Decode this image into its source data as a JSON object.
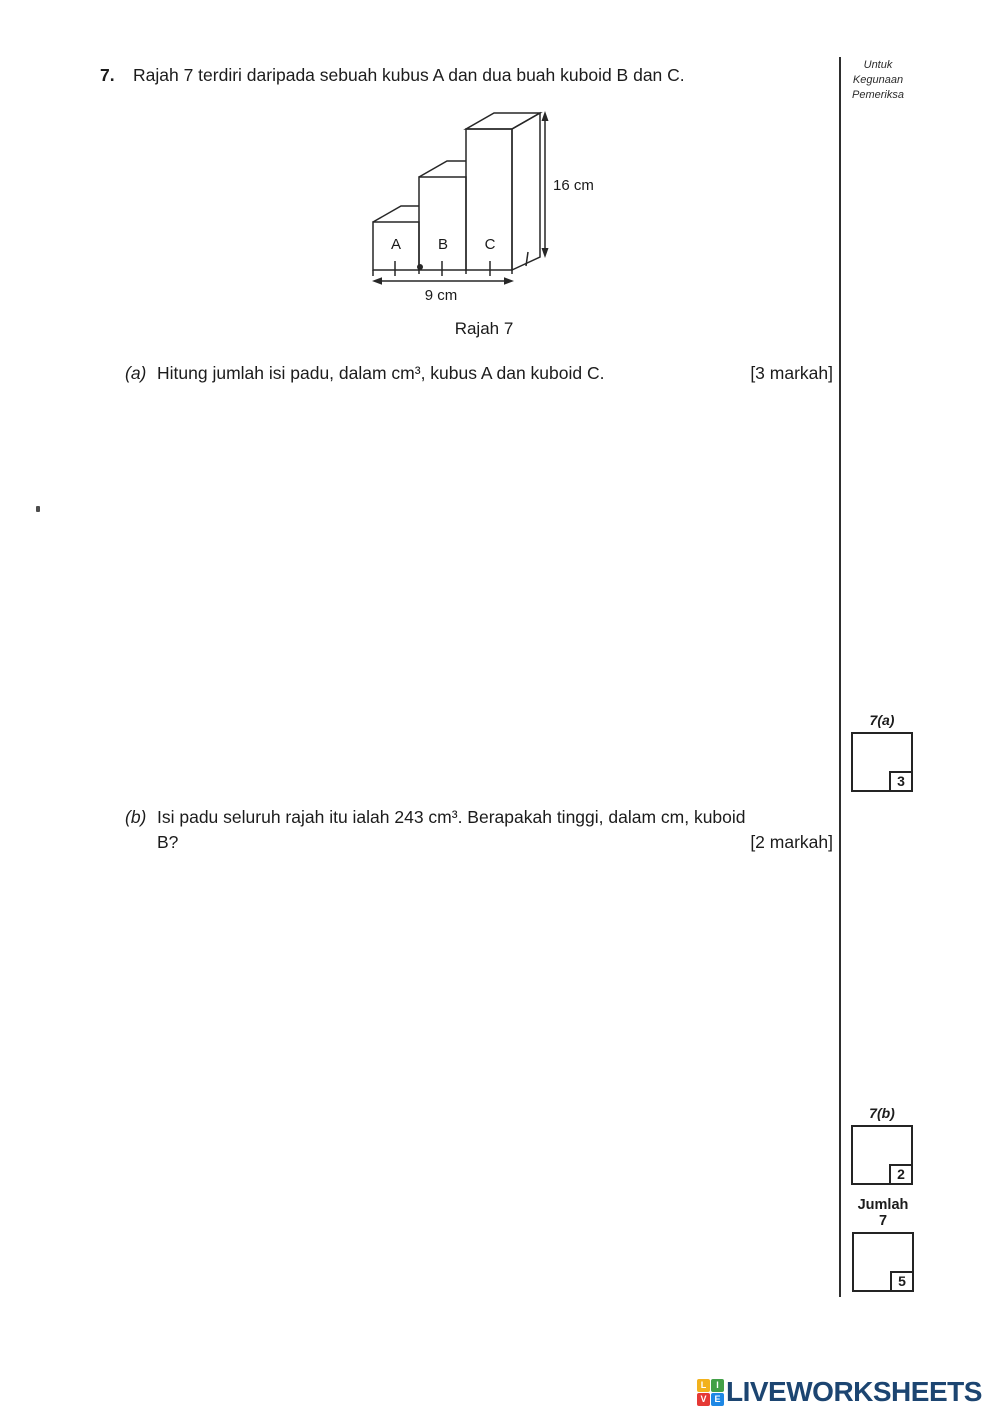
{
  "question": {
    "number": "7.",
    "text": "Rajah 7 terdiri daripada sebuah kubus A dan dua buah kuboid B dan C.",
    "parts": [
      {
        "letter": "(a)",
        "text": "Hitung jumlah isi padu, dalam cm³, kubus A dan kuboid C.",
        "marks": "[3 markah]"
      },
      {
        "letter": "(b)",
        "text_line1": "Isi padu seluruh rajah itu ialah 243 cm³. Berapakah tinggi, dalam cm, kuboid",
        "text_line2": "B?",
        "marks": "[2 markah]"
      }
    ]
  },
  "diagram": {
    "labels": {
      "a": "A",
      "b": "B",
      "c": "C"
    },
    "height_label": "16 cm",
    "base_label": "9 cm",
    "caption": "Rajah 7"
  },
  "examiner": {
    "header_line1": "Untuk",
    "header_line2": "Kegunaan",
    "header_line3": "Pemeriksa",
    "box_a": {
      "label": "7(a)",
      "marks": "3"
    },
    "box_b": {
      "label": "7(b)",
      "marks": "2"
    },
    "total": {
      "label_line1": "Jumlah",
      "label_line2": "7",
      "marks": "5"
    }
  },
  "footer": {
    "brand": "LIVEWORKSHEETS",
    "brand_color": "#1c4571",
    "icon": {
      "letters": [
        "L",
        "I",
        "V",
        "E"
      ],
      "colors": {
        "L": "#f2b21d",
        "I": "#43a047",
        "V": "#e53935",
        "E": "#1e88e5"
      }
    }
  }
}
